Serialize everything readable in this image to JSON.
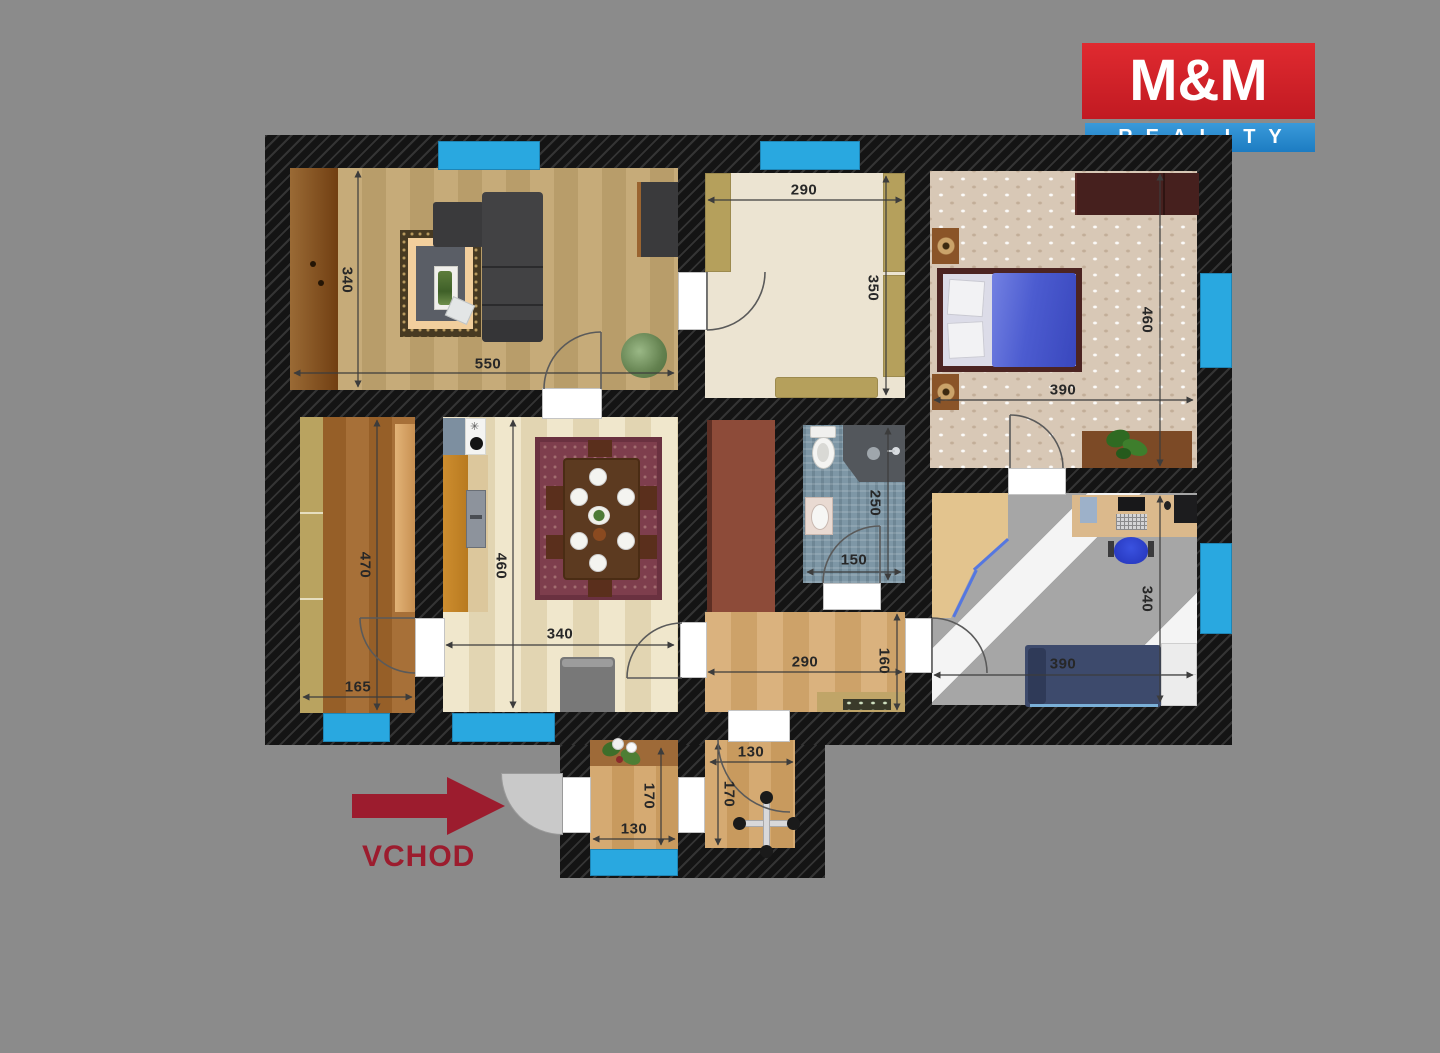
{
  "logo": {
    "title": "M&M",
    "subtitle": "REALITY"
  },
  "entrance": {
    "label": "VCHOD"
  },
  "icons": {
    "faucet": "✳"
  },
  "colors": {
    "background": "#8b8b8b",
    "wall": "#141414",
    "window": "#29a8e0",
    "logo_red": "#d62128",
    "logo_blue": "#2587cb",
    "entrance_red": "#9c1c2e"
  },
  "dims": {
    "living_h": "340",
    "living_w": "550",
    "closet_w": "290",
    "closet_h": "350",
    "bedroom_h": "460",
    "bedroom_w": "390",
    "storage_h": "470",
    "storage_w": "165",
    "kitchen_h": "460",
    "kitchen_w": "340",
    "bath_h": "250",
    "bath_w": "150",
    "hall_w": "290",
    "hall_h": "160",
    "office_h": "340",
    "office_w": "390",
    "entry_left_h": "170",
    "entry_left_w": "130",
    "entry_right_w": "130",
    "entry_right_h": "170"
  }
}
